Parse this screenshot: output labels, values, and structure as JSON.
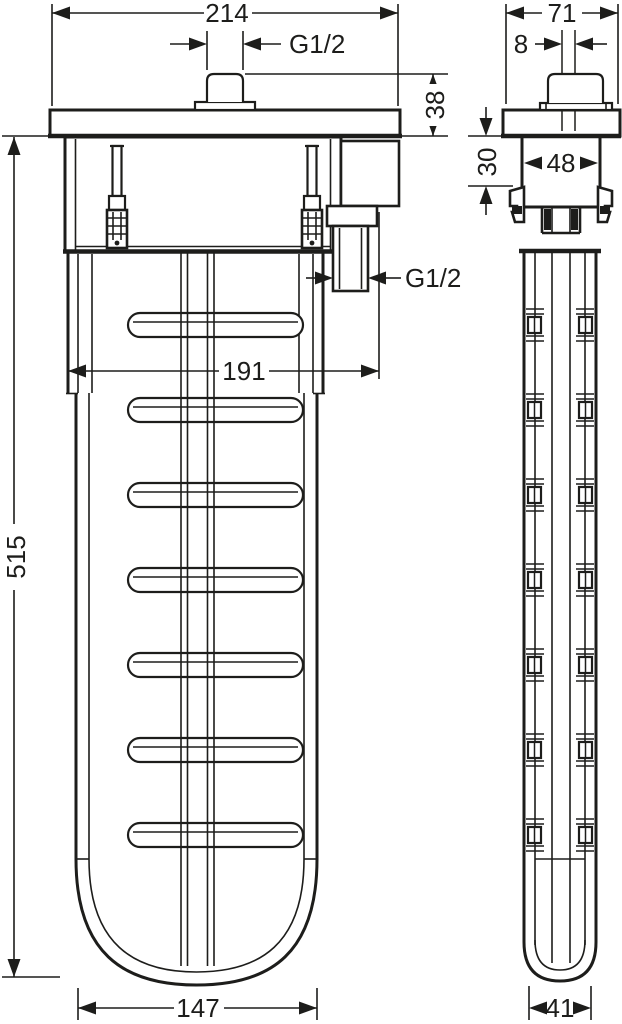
{
  "drawing": {
    "kind": "technical-dimension-drawing",
    "colors": {
      "line": "#1d1d1b",
      "background": "#ffffff"
    },
    "front_view": {
      "dims": {
        "overall_width": "214",
        "top_thread": "G1/2",
        "flange_height": "38",
        "outlet_thread": "G1/2",
        "outlet_offset": "191",
        "body_length": "515",
        "body_width": "147"
      }
    },
    "side_view": {
      "dims": {
        "overall_depth": "71",
        "button_offset": "8",
        "housing_width": "48",
        "install_depth": "30",
        "body_depth": "41"
      }
    }
  }
}
